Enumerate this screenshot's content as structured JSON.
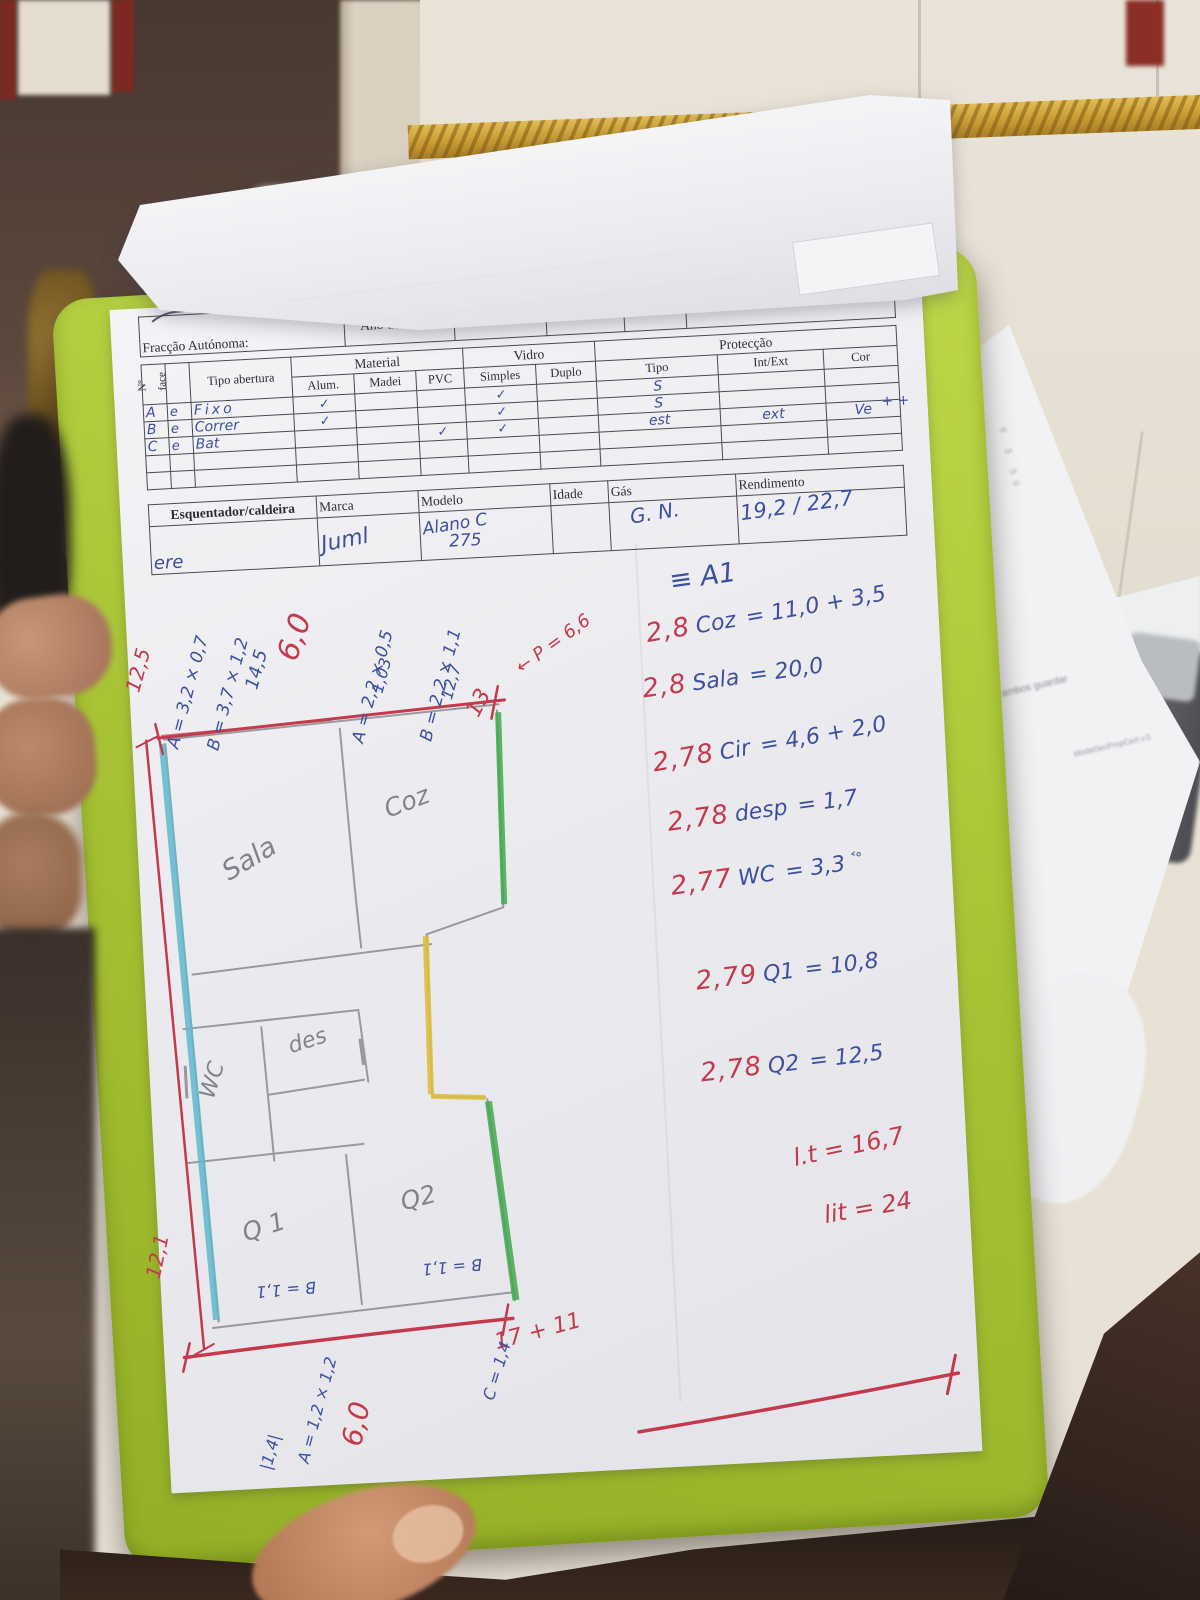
{
  "form": {
    "header_row": {
      "fraccao_autonoma": "Fracção Autónoma:",
      "ano_de_const": "Ano de Const:",
      "altitude": "Altitude:",
      "pre_frente": "Pré.Frente?",
      "elevador": "Elevador",
      "pavimento_cobertura": "Pavimento e Cobertura"
    },
    "openings_table": {
      "groups": {
        "material": "Material",
        "vidro": "Vidro",
        "proteccao": "Protecção"
      },
      "columns": {
        "num": "Nº",
        "face": "face",
        "tipo_abertura": "Tipo abertura",
        "alum": "Alum.",
        "madei": "Madei",
        "pvc": "PVC",
        "simples": "Simples",
        "duplo": "Duplo",
        "tipo": "Tipo",
        "int_ext": "Int/Ext",
        "cor": "Cor"
      },
      "rows": [
        {
          "num": "A",
          "face": "e",
          "tipo_abertura": "Fixo",
          "alum": "✓",
          "pvc": "",
          "simples": "✓",
          "duplo": "",
          "tipo": "S",
          "int_ext": "",
          "cor": ""
        },
        {
          "num": "B",
          "face": "e",
          "tipo_abertura": "Correr",
          "alum": "✓",
          "pvc": "",
          "simples": "✓",
          "duplo": "",
          "tipo": "S",
          "int_ext": "",
          "cor": ""
        },
        {
          "num": "C",
          "face": "e",
          "tipo_abertura": "Bat",
          "alum": "",
          "pvc": "✓",
          "simples": "✓",
          "duplo": "",
          "tipo": "est",
          "int_ext": "ext",
          "cor": "Ve"
        }
      ],
      "margin_note": "+ +"
    },
    "heater_table": {
      "columns": {
        "esquentador": "Esquentador/caldeira",
        "marca": "Marca",
        "modelo": "Modelo",
        "idade": "Idade",
        "gas": "Gás",
        "rendimento": "Rendimento"
      },
      "values": {
        "esquentador": "ere",
        "marca": "Juml",
        "modelo_line1": "Alano C",
        "modelo_line2": "275",
        "idade": "",
        "gas": "G. N.",
        "rendimento": "19,2 / 22,7"
      }
    }
  },
  "annotations": {
    "section_mark": "≡ A1",
    "ceiling_lines": [
      {
        "height": "2,8",
        "room": "Coz",
        "calc": "= 11,0 + 3,5"
      },
      {
        "height": "2,8",
        "room": "Sala",
        "calc": "= 20,0"
      },
      {
        "height": "2,78",
        "room": "Cir",
        "calc": "= 4,6 + 2,0"
      },
      {
        "height": "2,78",
        "room": "desp",
        "calc": "= 1,7"
      },
      {
        "height": "2,77",
        "room": "WC",
        "calc": "= 3,3",
        "note": "˂°"
      },
      {
        "height": "2,79",
        "room": "Q1",
        "calc": "= 10,8"
      },
      {
        "height": "2,78",
        "room": "Q2",
        "calc": "= 12,5"
      }
    ],
    "totals": [
      "l.t = 16,7",
      "lit = 24"
    ]
  },
  "floor_plan": {
    "rooms": [
      "Sala",
      "Coz",
      "WC",
      "des",
      "Q1",
      "Q2"
    ],
    "top_dims": [
      "12,5",
      "A = 3,2 × 0,7",
      "B = 3,7 × 1,2",
      "14,5",
      "6,0",
      "A = 2,2 × 0,5",
      "1,03",
      "B = 2,2 × 1,1",
      "12,7",
      "13",
      "← P = 6,6"
    ],
    "left_dim": "12,1",
    "bottom_dims": [
      "B = 1,1",
      "B = 1,1",
      "17 + 11",
      "6,0",
      "A = 1,2 × 1,2",
      "|1,4|",
      "C = 1,4"
    ]
  },
  "background": {
    "sheet_marks": "9 3 50",
    "sheet_text_1": "ambos guardar",
    "sheet_text_2": "ModeDecPropCert v.5"
  },
  "colors": {
    "clipboard_green": "#a8c435",
    "pen_red": "#c43a4c",
    "pen_blue": "#3d4f9e",
    "pencil_gray": "#90909a",
    "wall_cyan": "#5fb8cd",
    "wall_green": "#43a84c",
    "wall_yellow": "#debf3f",
    "tile_gold": "#cfa43c"
  }
}
